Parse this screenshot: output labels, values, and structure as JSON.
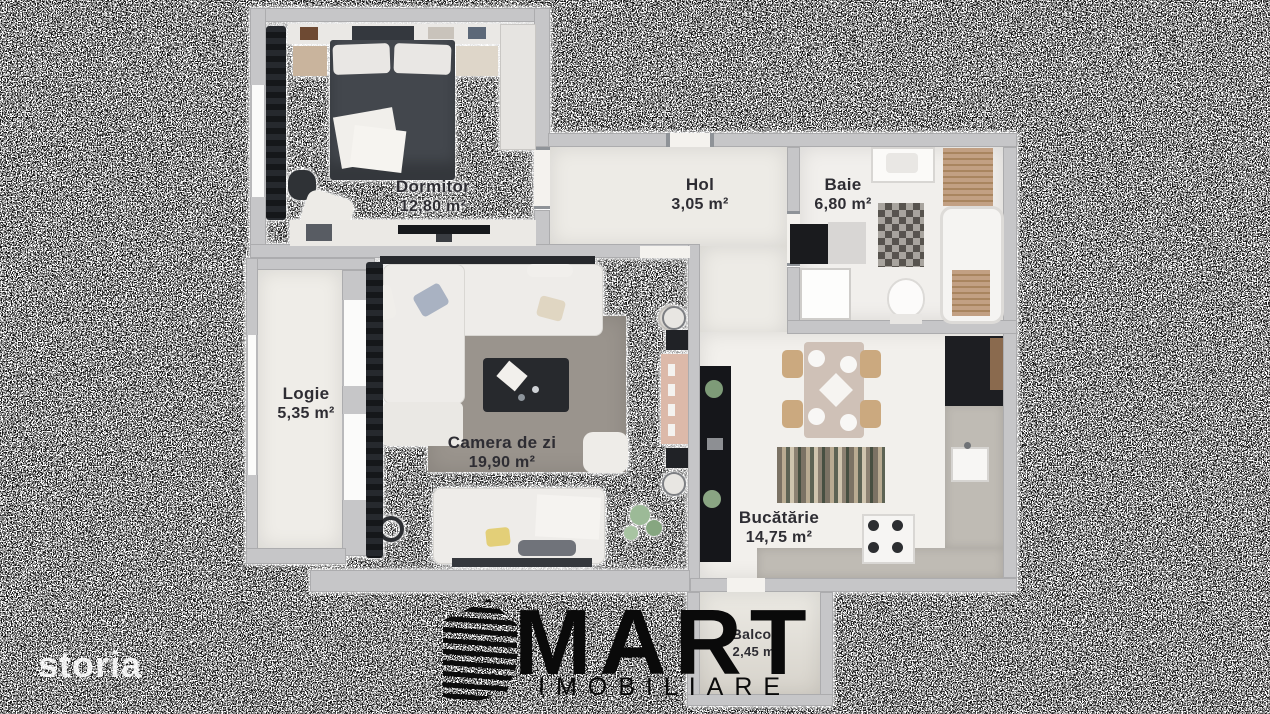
{
  "watermark": {
    "text": "storia"
  },
  "logo": {
    "name": "MART",
    "subtitle": "IMOBILIARE"
  },
  "rooms": [
    {
      "id": "dormitor",
      "name": "Dormitor",
      "area": "12,80 m²"
    },
    {
      "id": "hol",
      "name": "Hol",
      "area": "3,05 m²"
    },
    {
      "id": "baie",
      "name": "Baie",
      "area": "6,80 m²"
    },
    {
      "id": "logie",
      "name": "Logie",
      "area": "5,35 m²"
    },
    {
      "id": "camera-de-zi",
      "name": "Camera de zi",
      "area": "19,90 m²"
    },
    {
      "id": "bucatarie",
      "name": "Bucătărie",
      "area": "14,75 m²"
    },
    {
      "id": "balcon",
      "name": "Balcon",
      "area": "2,45 m²"
    }
  ],
  "colors": {
    "wall": "#c6c6c8",
    "wood_floor": "#b0a297",
    "light_floor": "#edebe6",
    "label_text": "#2e2d33",
    "logo_black": "#0a0a0a",
    "watermark_white": "#ffffff"
  }
}
